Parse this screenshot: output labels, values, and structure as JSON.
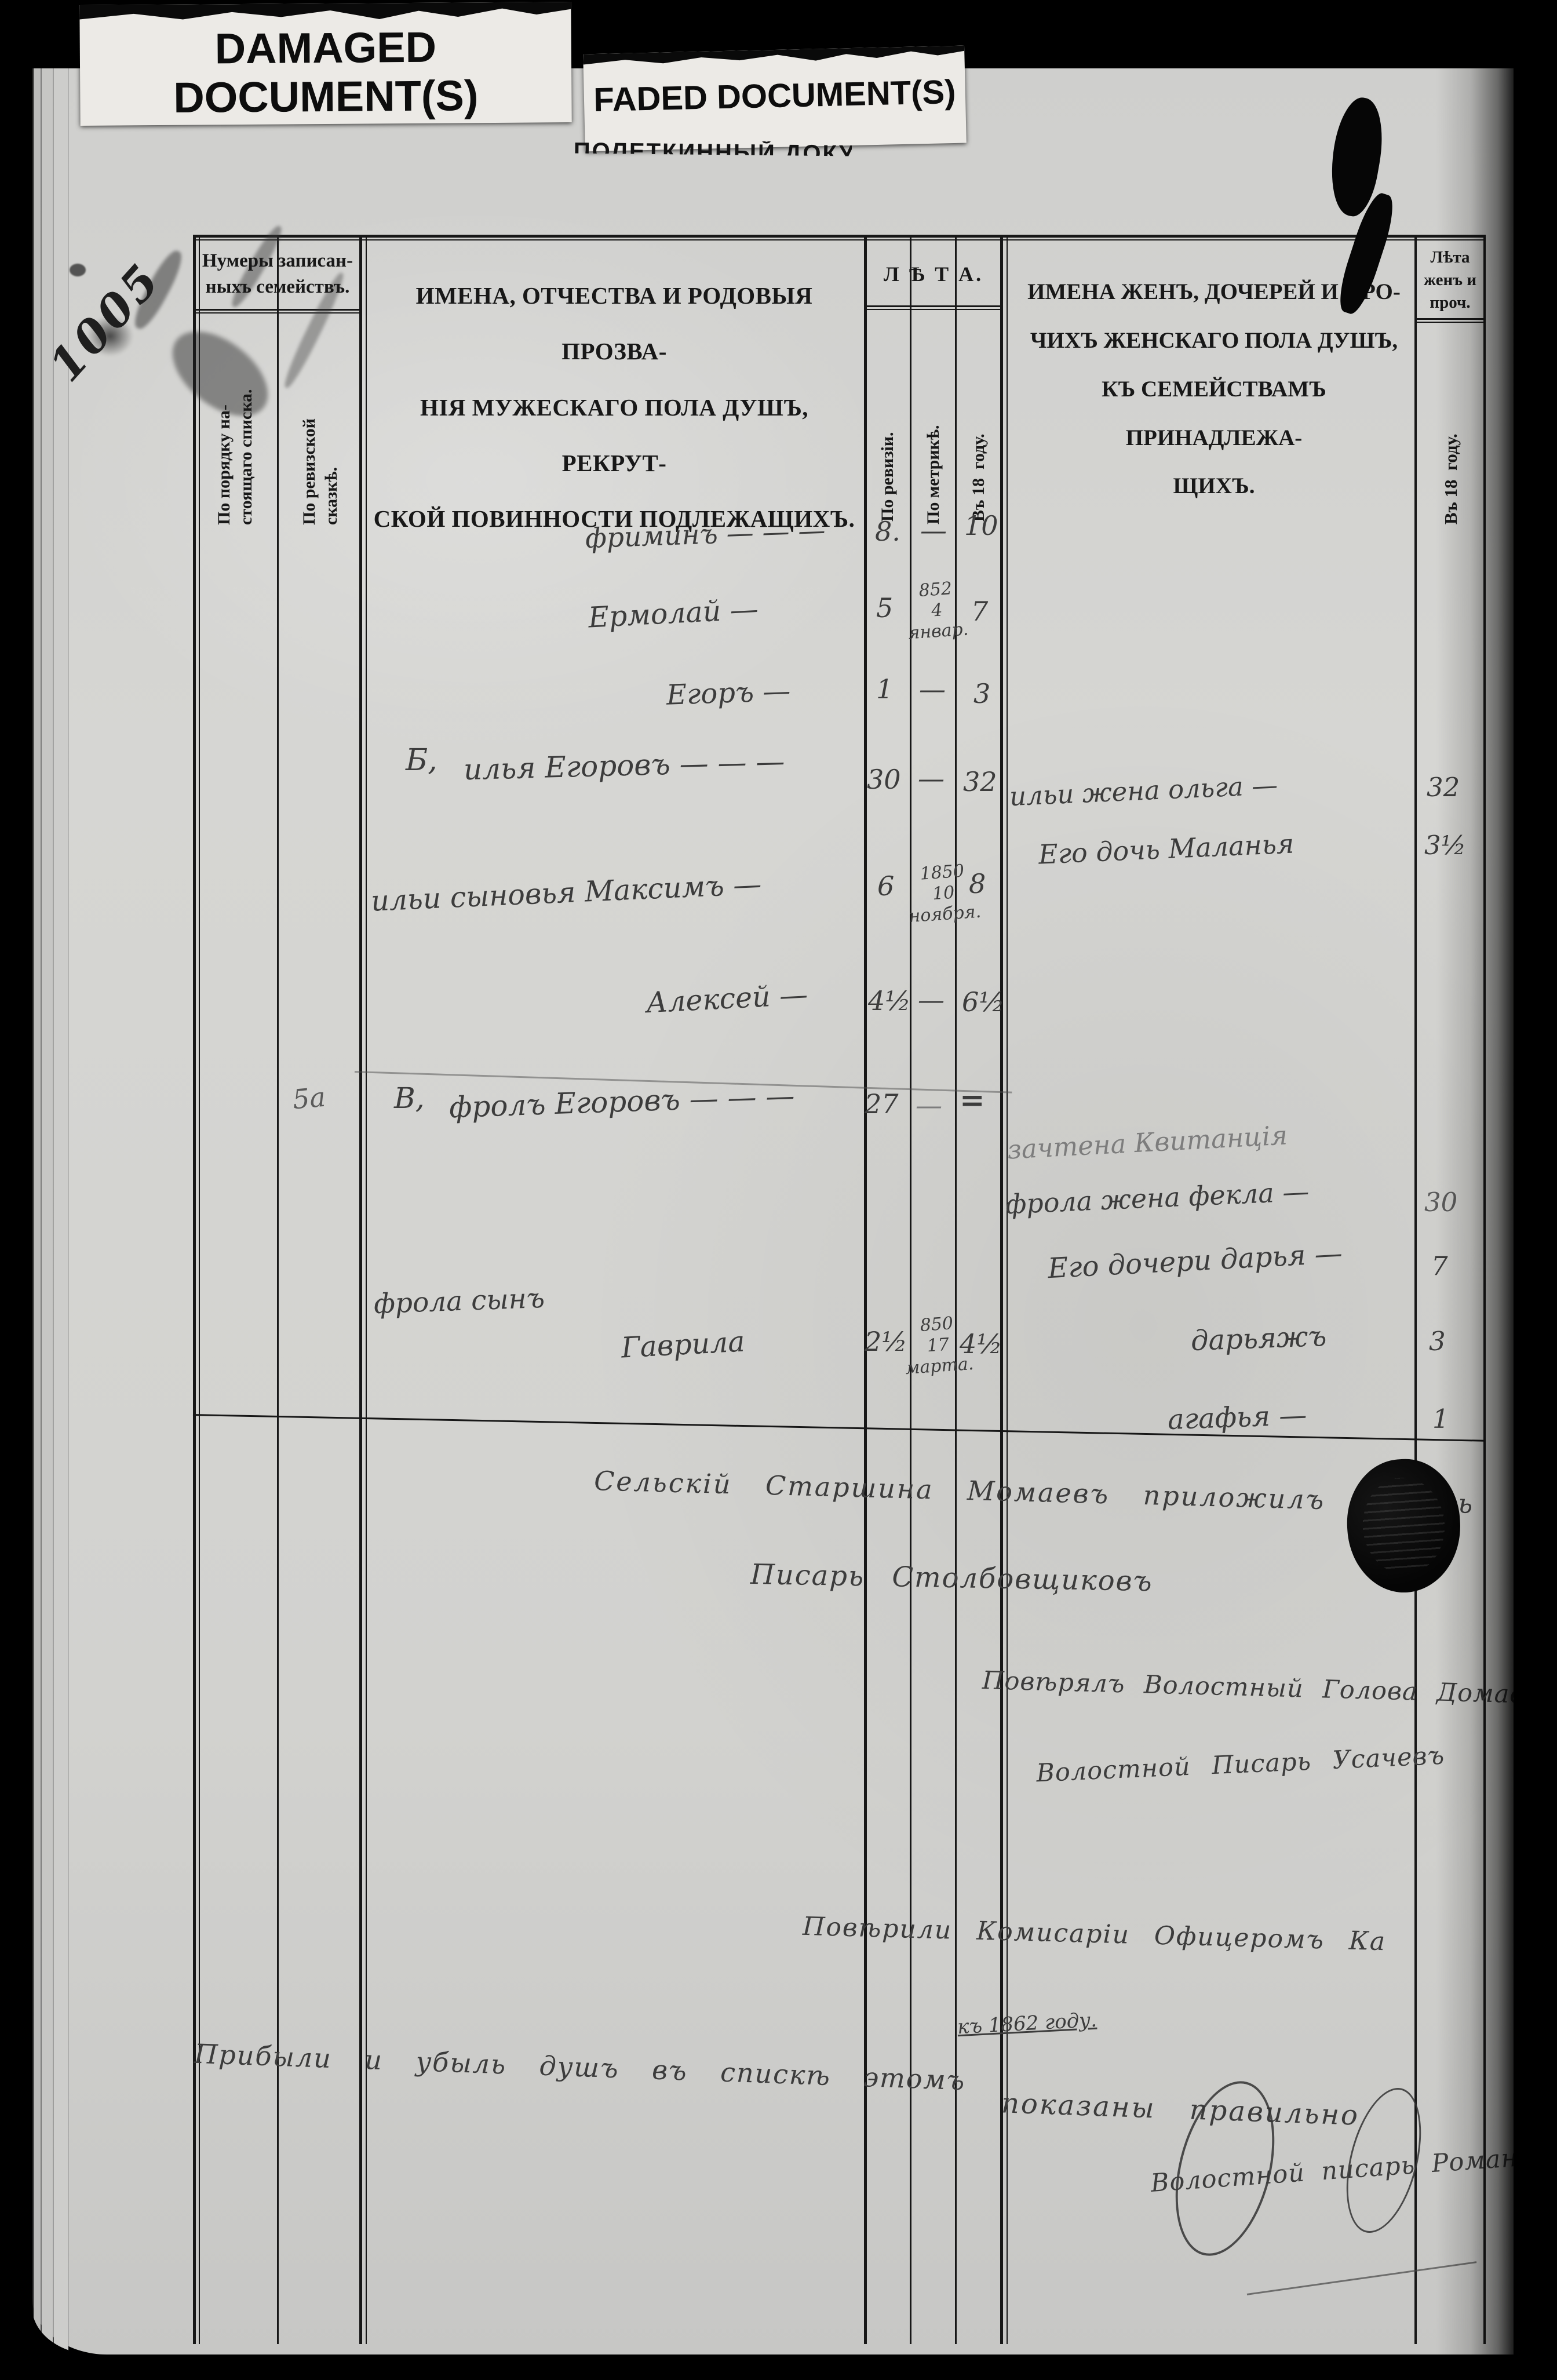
{
  "cards": {
    "damaged_line1": "DAMAGED",
    "damaged_line2": "DOCUMENT(S)",
    "faded": "FADED DOCUMENT(S)",
    "obscured_fragment": "ПОЛЕТКИННЫЙ ДОКУМЕНТ"
  },
  "margin_note": "1005",
  "header": {
    "family_numbers_group": "Нумеры записан-\nныхъ семействъ.",
    "col_order": "По порядку на-\nстоящаго списка.",
    "col_revision_tale": "По ревизской\nсказкѣ.",
    "male_names": "ИМЕНА, ОТЧЕСТВА И РОДОВЫЯ ПРОЗВА-\nНІЯ МУЖЕСКАГО ПОЛА ДУШЪ, РЕКРУТ-\nСКОЙ ПОВИННОСТИ ПОДЛЕЖАЩИХЪ.",
    "ages_group": "Л Ѣ Т А.",
    "col_by_revision": "По ревизіи.",
    "col_by_metric": "По метрикѣ.",
    "col_in_year": "Въ 18  году.",
    "female_names": "ИМЕНА ЖЕНЪ, ДОЧЕРЕЙ И ПРО-\nЧИХЪ ЖЕНСКАГО ПОЛА ДУШЪ,\nКЪ СЕМЕЙСТВАМЪ ПРИНАДЛЕЖА-\nЩИХЪ.",
    "female_ages_group": "Лѣта\nженъ и\nпроч.",
    "col_female_in_year": "Въ 18  году."
  },
  "male_rows": [
    {
      "no": "",
      "prefix": "",
      "name": "фриминъ — — —",
      "name2": "",
      "by_revision": "8.",
      "by_metric": "—",
      "in_year": "10"
    },
    {
      "no": "",
      "prefix": "",
      "name": "Ермолай —",
      "name2": "",
      "by_revision": "5",
      "by_metric": "852\n4\nянвар.",
      "in_year": "7"
    },
    {
      "no": "",
      "prefix": "",
      "name": "Егоръ —",
      "name2": "",
      "by_revision": "1",
      "by_metric": "—",
      "in_year": "3"
    },
    {
      "no": "",
      "prefix": "Б,",
      "name": "илья Егоровъ — — —",
      "name2": "",
      "by_revision": "30",
      "by_metric": "—",
      "in_year": "32"
    },
    {
      "no": "",
      "prefix": "",
      "name": "ильи сыновья Максимъ —",
      "name2": "",
      "by_revision": "6",
      "by_metric": "1850\n10\nноября.",
      "in_year": "8"
    },
    {
      "no": "",
      "prefix": "",
      "name": "Алексей —",
      "name2": "",
      "by_revision": "4½",
      "by_metric": "—",
      "in_year": "6½"
    },
    {
      "no": "5а",
      "prefix": "В,",
      "name": "фролъ Егоровъ — — —",
      "name2": "",
      "by_revision": "27",
      "by_metric": "—",
      "in_year": "="
    },
    {
      "no": "",
      "prefix": "",
      "name": "фрола сынъ",
      "name2": "Гаврила",
      "by_revision": "2½",
      "by_metric": "850\n17\nмарта.",
      "in_year": "4½"
    }
  ],
  "female_rows": [
    {
      "text": "ильи жена ольга —",
      "age": "32"
    },
    {
      "text": "Его дочь Маланья",
      "age": "3½"
    },
    {
      "text": "зачтена Квитанція",
      "age": ""
    },
    {
      "text": "фрола жена фекла —",
      "age": "30"
    },
    {
      "text": "Его дочери дарья —",
      "age": "7"
    },
    {
      "text": "дарьяжъ",
      "age": "3"
    },
    {
      "text": "агафья —",
      "age": "1"
    }
  ],
  "closing": {
    "village_elder_line": "Сельскій Старшина Момаевъ приложилъ печать",
    "scribe_line": "Писарь Столбовщиковъ",
    "verified_head_line": "Повѣрялъ Волостный Голова Домаевъ",
    "volost_scribe_line": "Волостной Писарь Усачевъ",
    "commission_line": "Повѣрили Комисаріи Офицеромъ Ка",
    "year_note": "къ 1862 году.",
    "correctness_line1": "Прибыли и убыль душъ въ спискѣ этомъ",
    "correctness_line2": "показаны правильно",
    "final_signature": "Волостной писарь Романовъ",
    "stamp_label": ""
  },
  "colors": {
    "background": "#000000",
    "paper": "#d3d3d0",
    "printed_ink": "#181818",
    "handwriting_ink": "#3c3c3c",
    "faded_ink": "#7d7d7d",
    "card": "#eceae6"
  }
}
